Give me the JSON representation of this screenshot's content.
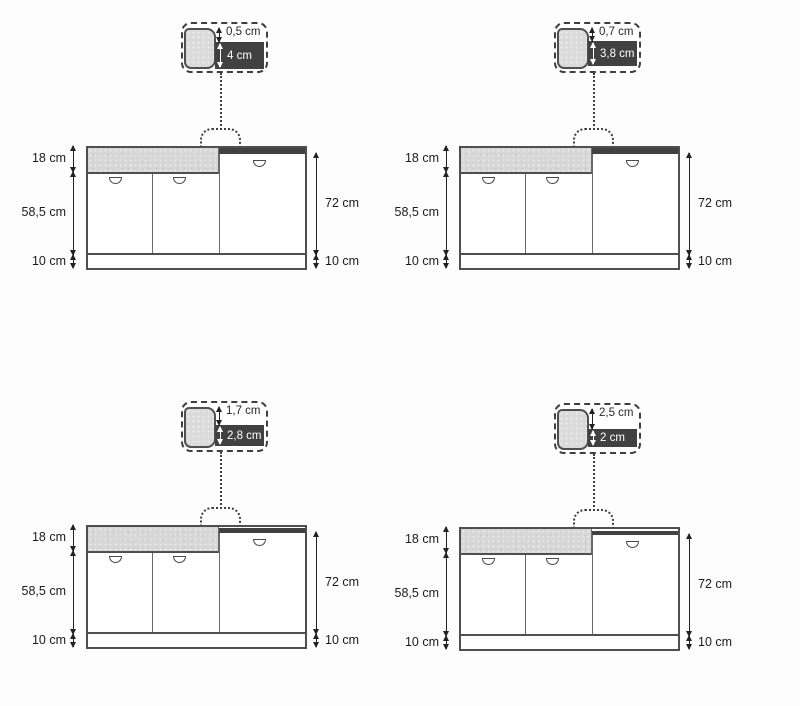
{
  "colors": {
    "worktop_dark": "#414141",
    "fascia_gray": "#d7d7d7",
    "outline": "#4f4f4f",
    "background": "#fdfdfd"
  },
  "quadrants": [
    {
      "id": "top-left",
      "callout": {
        "overhang": "0,5 cm",
        "thickness": "4 cm"
      },
      "dims": {
        "upper": "18 cm",
        "doors": "58,5 cm",
        "plinth_left": "10 cm",
        "right_height": "72 cm",
        "plinth_right": "10 cm"
      }
    },
    {
      "id": "top-right",
      "callout": {
        "overhang": "0,7 cm",
        "thickness": "3,8 cm"
      },
      "dims": {
        "upper": "18 cm",
        "doors": "58,5 cm",
        "plinth_left": "10 cm",
        "right_height": "72 cm",
        "plinth_right": "10 cm"
      }
    },
    {
      "id": "bottom-left",
      "callout": {
        "overhang": "1,7 cm",
        "thickness": "2,8 cm"
      },
      "dims": {
        "upper": "18 cm",
        "doors": "58,5 cm",
        "plinth_left": "10 cm",
        "right_height": "72 cm",
        "plinth_right": "10 cm"
      }
    },
    {
      "id": "bottom-right",
      "callout": {
        "overhang": "2,5 cm",
        "thickness": "2 cm"
      },
      "dims": {
        "upper": "18 cm",
        "doors": "58,5 cm",
        "plinth_left": "10 cm",
        "right_height": "72 cm",
        "plinth_right": "10 cm"
      }
    }
  ]
}
